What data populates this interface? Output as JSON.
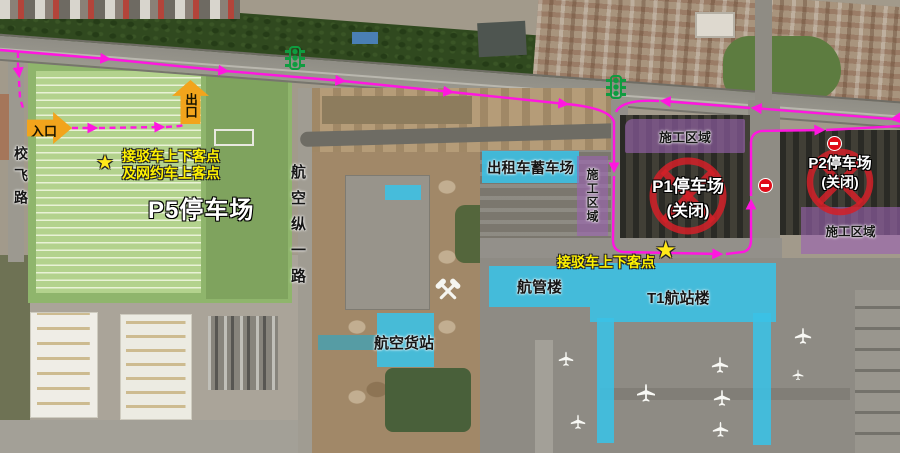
{
  "parking_p5": {
    "name": "P5停车场",
    "entrance": "入口",
    "exit": "出口",
    "shuttle_note_line1": "接驳车上下客点",
    "shuttle_note_line2": "及网约车上客点"
  },
  "parking_p1": {
    "name": "P1停车场",
    "status": "(关闭)"
  },
  "parking_p2": {
    "name": "P2停车场",
    "status": "(关闭)"
  },
  "roads": {
    "xiaofei": "校飞路",
    "hangkong_zongyi": "航空纵一路"
  },
  "facilities": {
    "taxi_pool": "出租车蓄车场",
    "atc": "航管楼",
    "terminal_t1": "T1航站楼",
    "air_cargo": "航空货站"
  },
  "construction": {
    "zone_mid": "施工区域",
    "zone_p1": "施工区域",
    "zone_p2": "施工区域"
  },
  "shuttle": {
    "t1_stop": "接驳车上下客点"
  },
  "icons": {
    "traffic_signal": "traffic-light-icon",
    "closed_parking": "no-entry-cross-circle",
    "road_closed_badge": "no-entry-badge",
    "shuttle_stop_marker": "star",
    "construction_marker": "crossed-hammers",
    "aircraft_marker": "plane"
  },
  "colors": {
    "route_magenta": "#FF16E0",
    "highlight_cyan": "#3AC2E6",
    "highlight_purple": "#9A62B0",
    "closed_red": "#D42028",
    "arrow_orange": "#F2A41C",
    "note_yellow": "#FFF200",
    "signal_green": "#0F9C40"
  }
}
